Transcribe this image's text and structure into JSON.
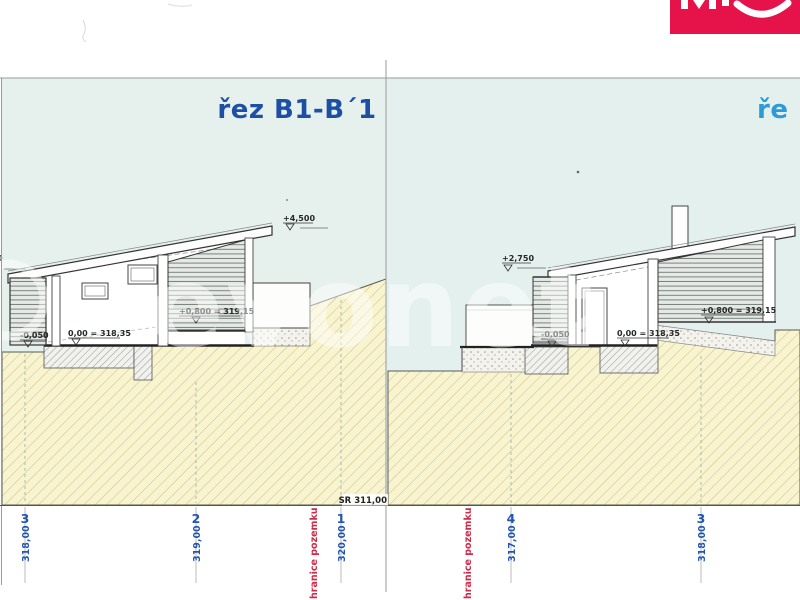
{
  "logo": {
    "name": "evonet",
    "color": "#e5134a"
  },
  "watermark": {
    "text": "evonet"
  },
  "left": {
    "title": "řez B1-B´1",
    "labels": {
      "ridge": "+4,500",
      "upper_floor": "+0,800 = 319,15",
      "floor": "0,00 = 318,35",
      "terrace": "-0,050",
      "edge_partial": "0"
    },
    "datum": "SR 311,00",
    "boundary": "hranice pozemku",
    "stations": [
      {
        "num": "3",
        "elev": "318,00"
      },
      {
        "num": "2",
        "elev": "319,00"
      },
      {
        "num": "1",
        "elev": "320,00"
      }
    ]
  },
  "right": {
    "title": "ře",
    "labels": {
      "pergola": "+2,750",
      "terrace": "-0,050",
      "floor": "0,00 = 318,35",
      "upper_floor": "+0,800 = 319,15"
    },
    "boundary": "hranice pozemku",
    "stations": [
      {
        "num": "4",
        "elev": "317,00"
      },
      {
        "num": "3",
        "elev": "318,00"
      }
    ]
  },
  "colors": {
    "title_left": "#1d4fa5",
    "title_right": "#2d9bd5",
    "station_blue": "#2356ae",
    "boundary_red": "#cf2b4b",
    "ground_yellow": "#f8f4cf",
    "sky": "#e6f1ee",
    "logo_red": "#e5134a"
  }
}
